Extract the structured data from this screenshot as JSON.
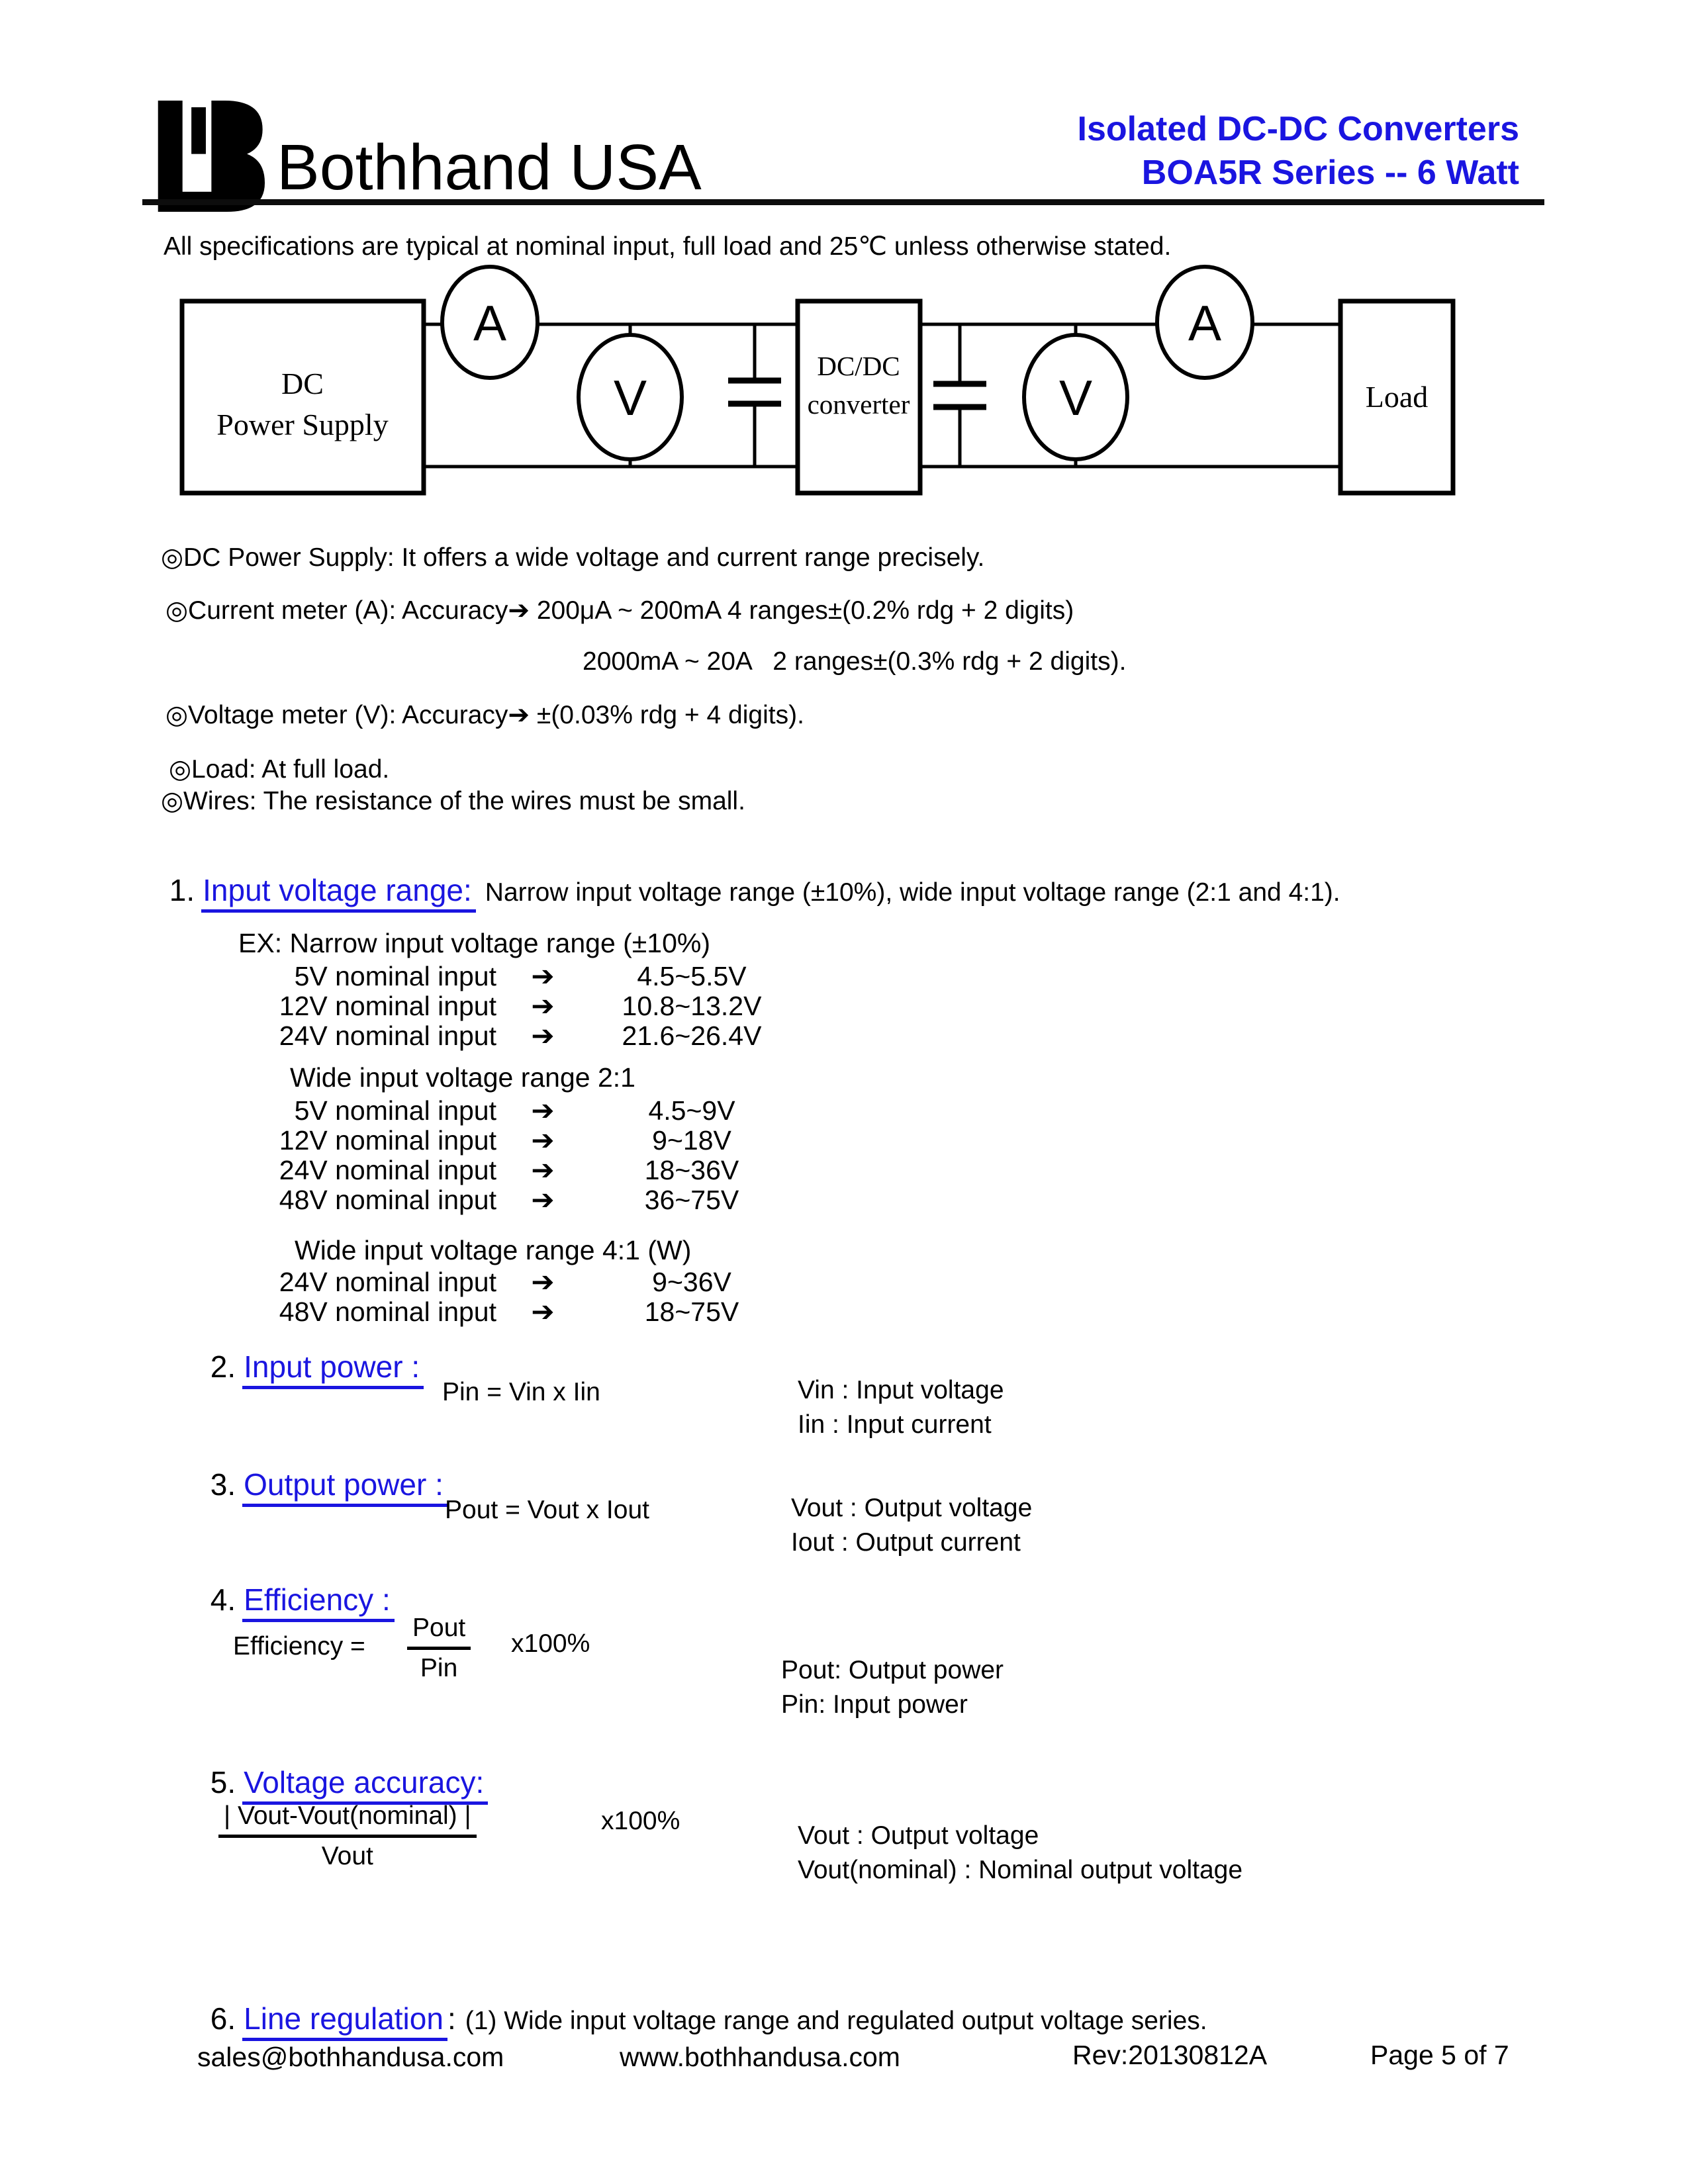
{
  "colors": {
    "accent_blue": "#1a15e0",
    "rule_black": "#0d0d0d"
  },
  "header": {
    "brand": "Bothhand USA",
    "title1": "Isolated DC-DC Converters",
    "title2": "BOA5R Series -- 6 Watt"
  },
  "intro": "All specifications are typical at nominal input, full load and 25℃ unless otherwise stated.",
  "diagram": {
    "supply1": "DC",
    "supply2": "Power Supply",
    "ammeter_in": "A",
    "ammeter_out": "A",
    "voltmeter_in": "V",
    "voltmeter_out": "V",
    "converter1": "DC/DC",
    "converter2": "converter",
    "load": "Load"
  },
  "notes": {
    "n1": "◎DC Power Supply: It offers a wide voltage and current range precisely.",
    "n2": "◎Current meter (A): Accuracy➔ 200μA ~ 200mA 4 ranges±(0.2% rdg + 2 digits)",
    "n2b": "2000mA ~ 20A   2 ranges±(0.3% rdg + 2 digits).",
    "n3": "◎Voltage meter (V): Accuracy➔ ±(0.03% rdg + 4 digits).",
    "n4": "◎Load: At full load.",
    "n5": "◎Wires: The resistance of the wires must be small."
  },
  "section1": {
    "num": "1.",
    "title": "Input voltage range:",
    "desc": "Narrow input voltage range (±10%), wide input voltage range (2:1 and 4:1).",
    "ex_title": "EX: Narrow input voltage range (±10%)",
    "narrow_rows": [
      {
        "label": "5V nominal input",
        "arrow": "➔",
        "value": "4.5~5.5V"
      },
      {
        "label": "12V nominal input",
        "arrow": "➔",
        "value": "10.8~13.2V"
      },
      {
        "label": "24V nominal input",
        "arrow": "➔",
        "value": "21.6~26.4V"
      }
    ],
    "wide2_title": "Wide input voltage range 2:1",
    "wide2_rows": [
      {
        "label": "5V nominal input",
        "arrow": "➔",
        "value": "4.5~9V"
      },
      {
        "label": "12V nominal input",
        "arrow": "➔",
        "value": "9~18V"
      },
      {
        "label": "24V nominal input",
        "arrow": "➔",
        "value": "18~36V"
      },
      {
        "label": "48V nominal input",
        "arrow": "➔",
        "value": "36~75V"
      }
    ],
    "wide4_title": "Wide input voltage range 4:1 (W)",
    "wide4_rows": [
      {
        "label": "24V nominal input",
        "arrow": "➔",
        "value": "9~36V"
      },
      {
        "label": "48V nominal input",
        "arrow": "➔",
        "value": "18~75V"
      }
    ]
  },
  "section2": {
    "num": "2.",
    "title": "Input power :",
    "formula": "Pin = Vin x Iin",
    "def1": "Vin : Input voltage",
    "def2": "Iin : Input current"
  },
  "section3": {
    "num": "3.",
    "title": "Output power :",
    "formula": "Pout = Vout x Iout",
    "def1": "Vout : Output voltage",
    "def2": "Iout : Output current"
  },
  "section4": {
    "num": "4.",
    "title": "Efficiency :",
    "lhs": "Efficiency =",
    "frac_num": "Pout",
    "frac_den": "Pin",
    "rhs": "x100%",
    "def1": "Pout: Output power",
    "def2": "Pin: Input power"
  },
  "section5": {
    "num": "5.",
    "title": "Voltage accuracy:",
    "frac_num": "| Vout-Vout(nominal) |",
    "frac_den": "Vout",
    "rhs": "x100%",
    "def1": "Vout : Output voltage",
    "def2": "Vout(nominal) : Nominal output voltage"
  },
  "section6": {
    "num": "6.",
    "title": "Line regulation",
    "colon": ":",
    "desc": "(1) Wide input voltage range and regulated output voltage series."
  },
  "footer": {
    "email": "sales@bothhandusa.com",
    "website": "www.bothhandusa.com",
    "rev": "Rev:20130812A",
    "page": "Page 5 of 7"
  }
}
